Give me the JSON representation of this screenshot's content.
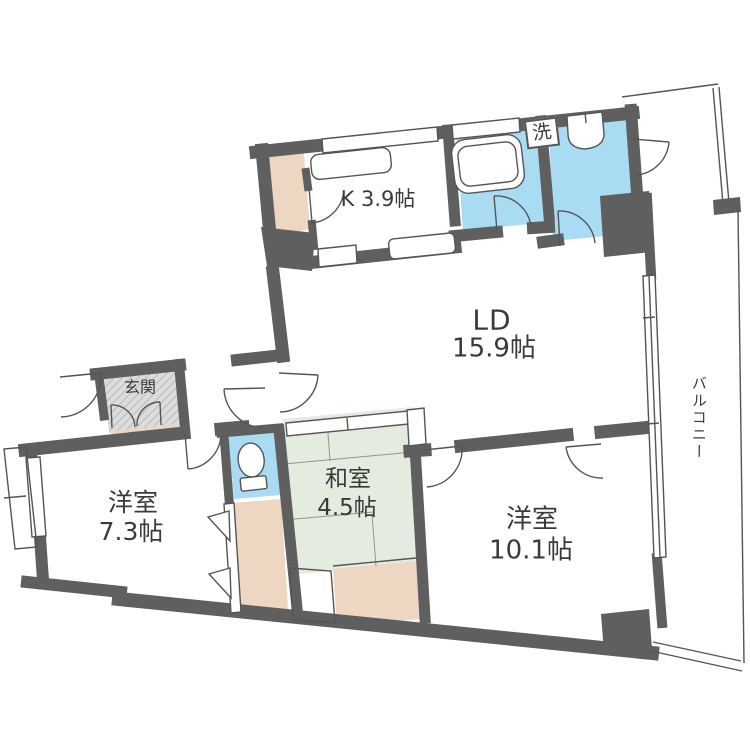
{
  "title": "apartment-floor-plan",
  "unit": "帖",
  "colors": {
    "wall": "#5f5f5f",
    "water": "#a9dbf3",
    "tatami": "#e3ecdf",
    "closet": "#edd7c2",
    "entrance": "#dcdcdc",
    "outline": "#555555",
    "text": "#3a3a3a",
    "floor": "#ffffff"
  },
  "rooms": {
    "kitchen": {
      "label": "K 3.9帖"
    },
    "living": {
      "name": "LD",
      "size": "15.9帖"
    },
    "western1": {
      "name": "洋室",
      "size": "7.3帖"
    },
    "western2": {
      "name": "洋室",
      "size": "10.1帖"
    },
    "japanese": {
      "name": "和室",
      "size": "4.5帖"
    },
    "entrance": {
      "label": "玄関"
    },
    "laundry": {
      "label": "洗"
    },
    "balcony": {
      "label": "バルコニー"
    }
  }
}
